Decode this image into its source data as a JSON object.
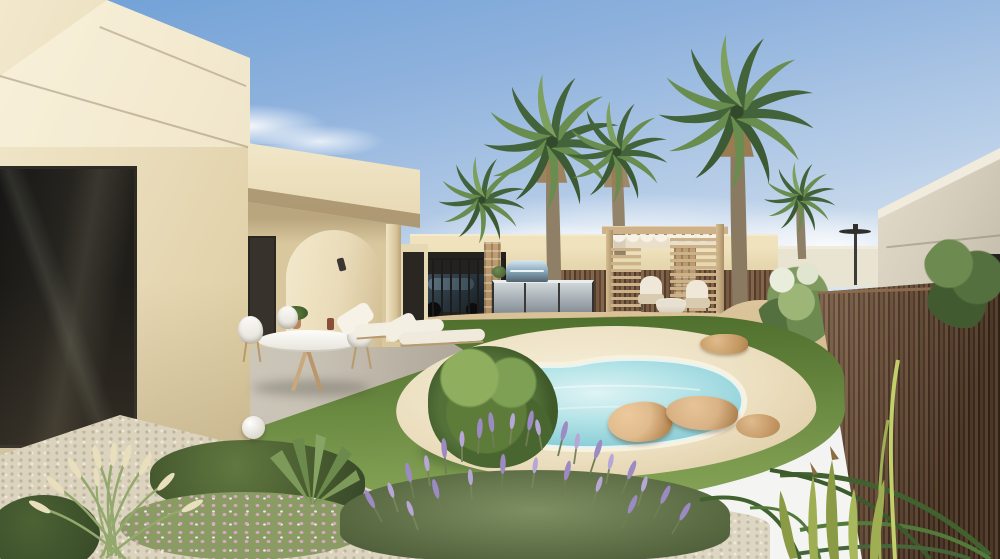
{
  "scene": {
    "type": "architectural-exterior-render",
    "description": "Sunny 3D render of a modern cream-coloured Mediterranean villa: covered veranda with arch feature, round dining set and two sun loungers, lawn garden with freeform sand-edged swimming pool and boulders, timber pergola lounge with fire bowl, stainless outdoor kitchen with barbecue, parked dark SUV under a carport, tall fan palms, lavender and ornamental grasses in gravel beds, a brown reed privacy fence, a white neighbouring villa, a street lamp and distant mountains under a pale blue sky.",
    "elements": [
      "left-villa-facade",
      "veranda-arch",
      "wall-sconce",
      "dining-set",
      "sun-loungers",
      "sphere-lamp",
      "lawn",
      "swimming-pool",
      "pool-boulders",
      "pergola-lounge",
      "fire-bowl",
      "outdoor-kitchen",
      "barbecue",
      "parked-suv",
      "carport-railing",
      "fan-palms",
      "reed-fence",
      "neighbour-villa",
      "street-lamp",
      "mountains",
      "clouds",
      "lavender-bush",
      "ornamental-grass",
      "aloe-plants",
      "gravel-bed",
      "pink-groundcover"
    ]
  },
  "palette": {
    "sky_top": "#6fa0d6",
    "sky_mid": "#b9cfe8",
    "sky_horizon": "#eef1f1",
    "cloud": "#ffffff",
    "mountain": "#978d79",
    "wall_lit": "#f2e8cc",
    "wall_main": "#e7d9b4",
    "wall_shadow": "#cdb88e",
    "soffit": "#a8946e",
    "window_dark": "#24221f",
    "bg_wall": "#e6d7ae",
    "inner_fence": "#6b5340",
    "stone": "#c2a074",
    "steel_light": "#cfd6d9",
    "steel_dark": "#6f787d",
    "bbq_blue": "#8fb0c4",
    "carport_dark": "#24221f",
    "suv_body": "#2c3a44",
    "right_wall": "#d5cdbc",
    "right_wall_light": "#f0ebdd",
    "fence_a": "#6e5038",
    "fence_b": "#54392a",
    "fence_c": "#7b5c42",
    "fence_d": "#46301f",
    "lawn_far": "#50702e",
    "lawn_near": "#7b9a4e",
    "patio": "#c9c3b6",
    "sand_light": "#f6efda",
    "sand_dark": "#d9c59b",
    "water_light": "#dff3f4",
    "water_mid": "#a9dfe4",
    "water_deep": "#7cc2cf",
    "coping": "#f7f1e0",
    "rock_light": "#e0bb8d",
    "rock_dark": "#aa7f4e",
    "wood": "#cdb189",
    "wood_dark": "#a98f68",
    "cushion": "#efe8d8",
    "palm_dark": "#43633a",
    "palm_light": "#698c4f",
    "trunk": "#8f7f66",
    "skirt": "#9a7c52",
    "lavender1": "#9c8ac2",
    "lavender2": "#b7a7d6",
    "lav_stem": "#6f7d52",
    "foliage_dark": "#3f5a28",
    "foliage_mid": "#5d7c3a",
    "foliage_light": "#8fae5e",
    "plume": "#e9dfbd",
    "gravel": "#dbd3bd",
    "gravel_dot": "#bfb69e",
    "pink": "#d9a9c3",
    "deck": "#cfa97b",
    "dirt": "#d9c298",
    "aloe": "#9fae52"
  }
}
